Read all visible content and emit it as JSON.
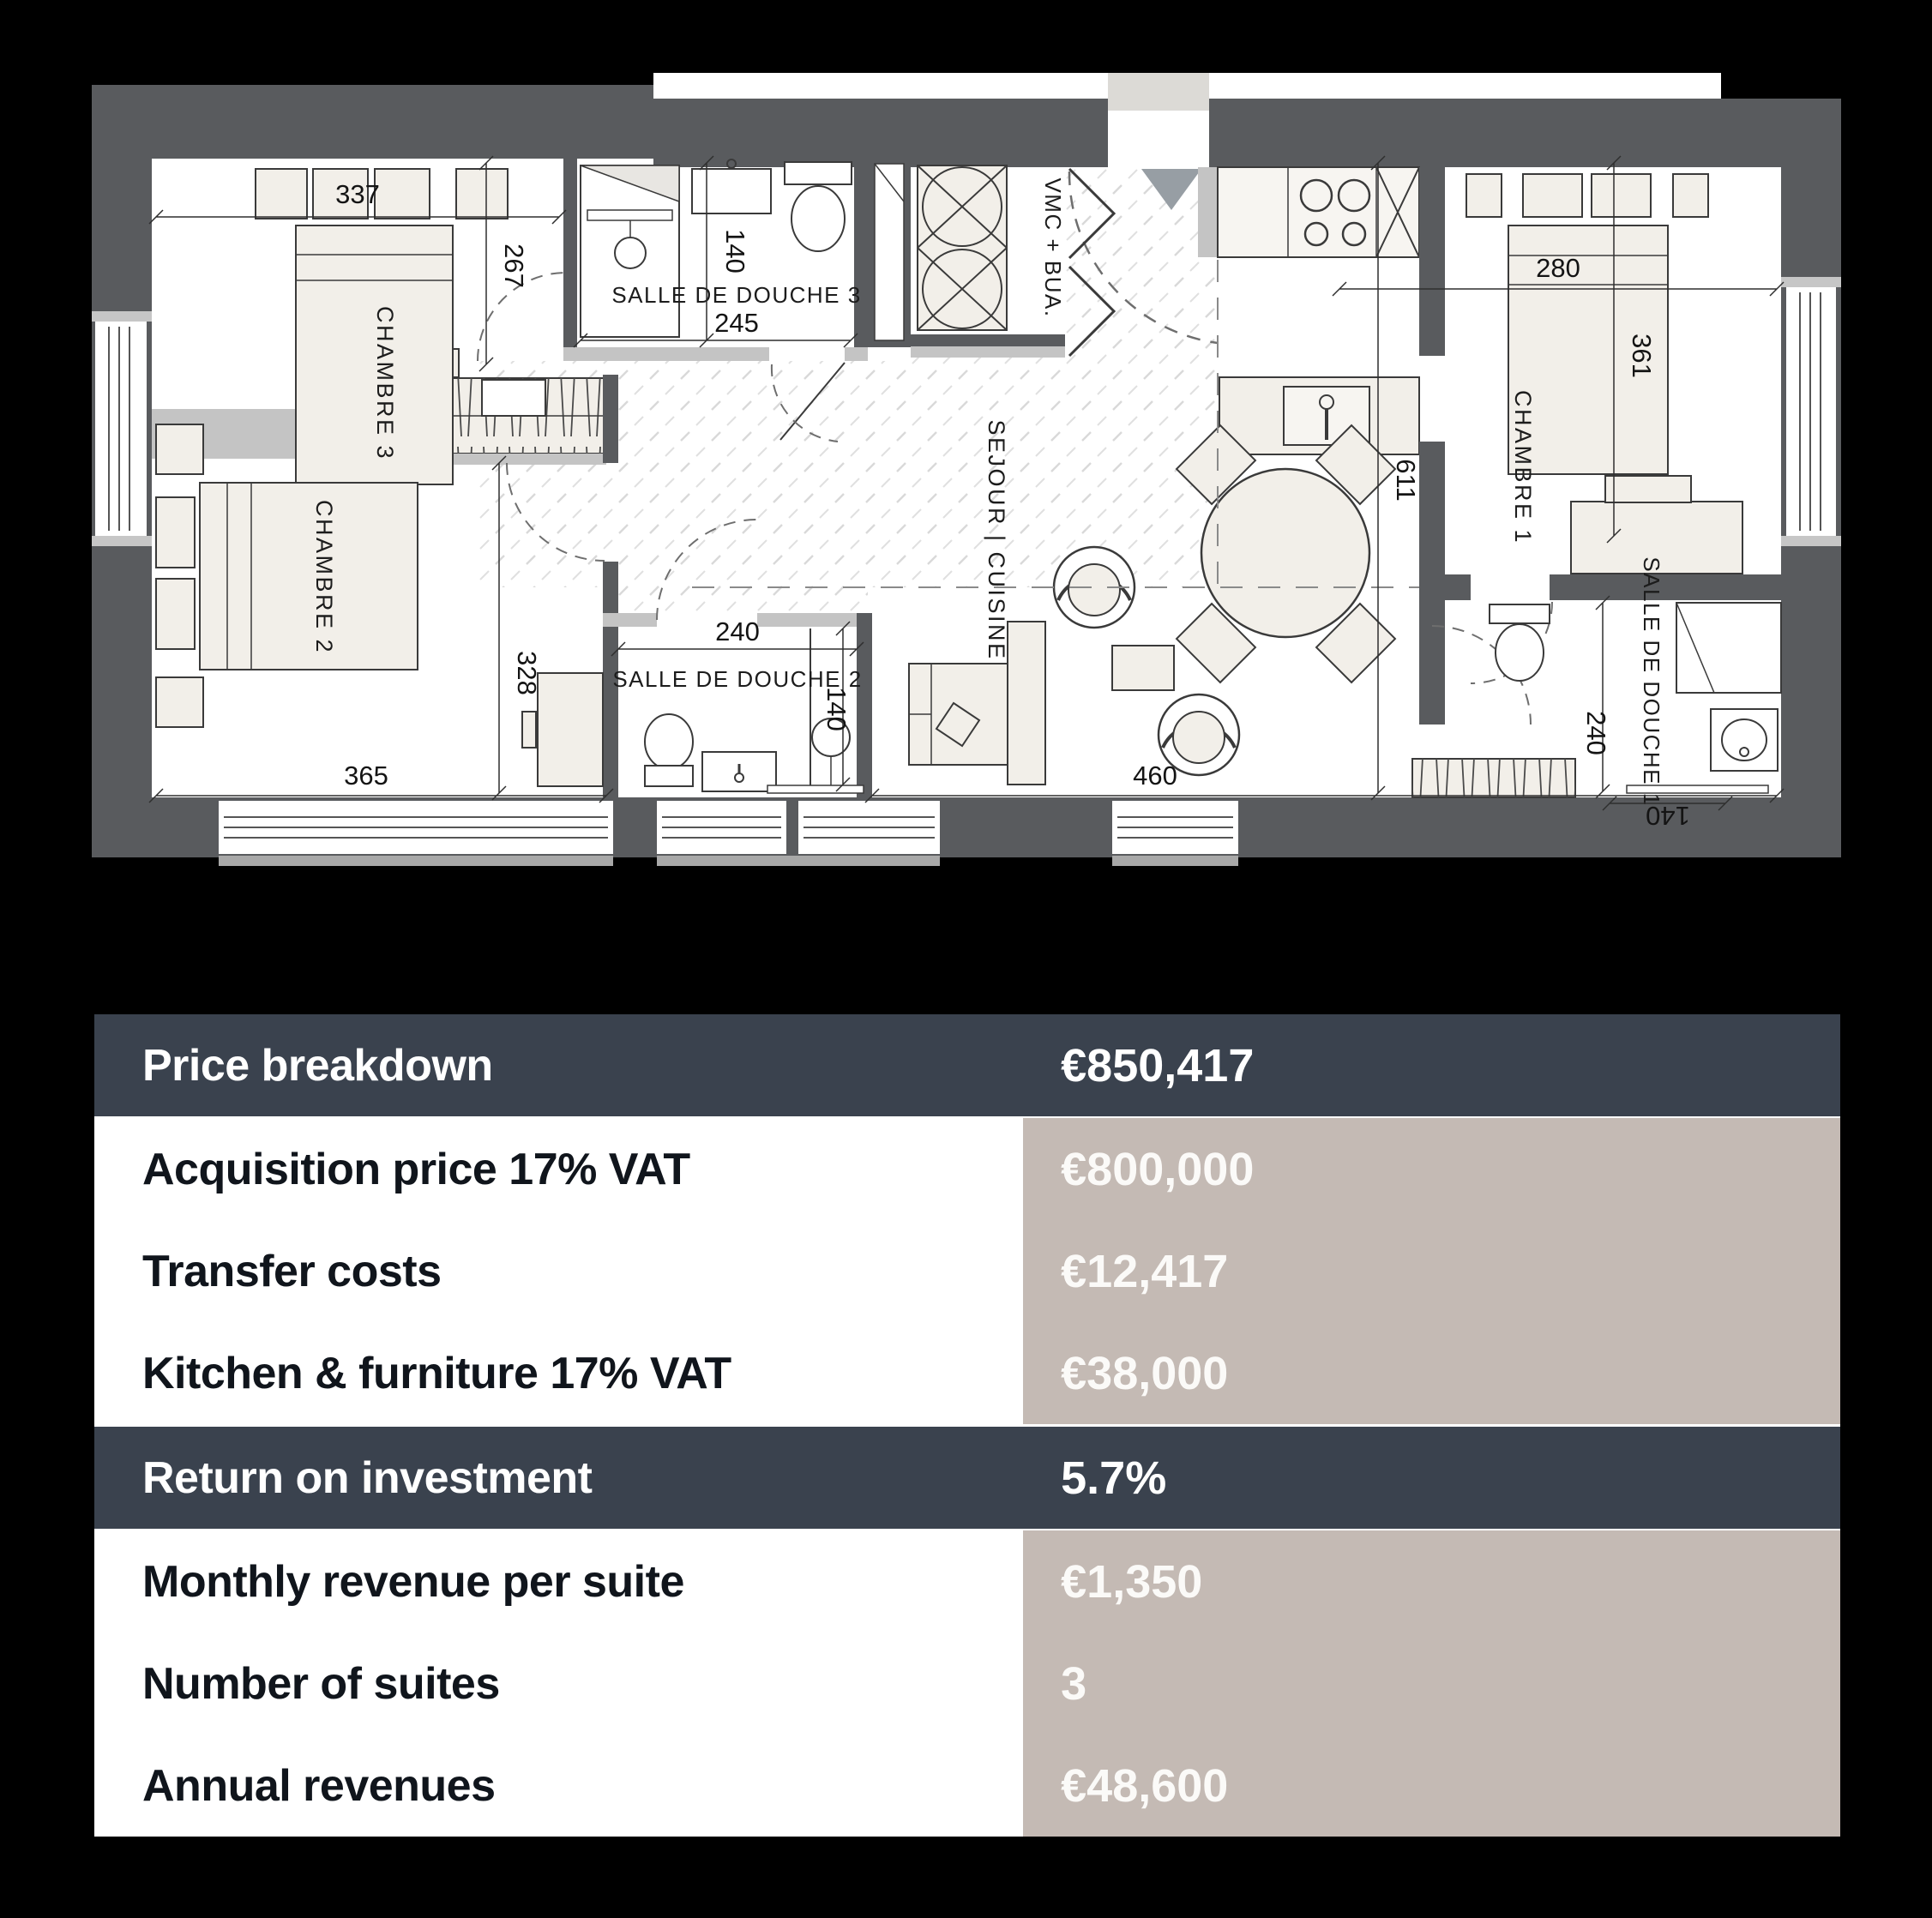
{
  "plan": {
    "rooms": {
      "chambre3": "CHAMBRE 3",
      "chambre2": "CHAMBRE 2",
      "chambre1": "CHAMBRE 1",
      "sdd3": "SALLE DE DOUCHE 3",
      "sdd2": "SALLE DE DOUCHE 2",
      "sdd1": "SALLE DE DOUCHE 1",
      "sejour": "SEJOUR | CUISINE",
      "vmc": "VMC + BUA."
    },
    "dims": {
      "chambre3_width": "337",
      "chambre3_height": "267",
      "sdd3_height": "140",
      "sdd3_width": "245",
      "chambre1_width": "280",
      "chambre1_height": "361",
      "sejour_height": "611",
      "chambre2_height": "328",
      "chambre2_width": "365",
      "sdd2_width": "240",
      "sdd2_height": "140",
      "sejour_width": "460",
      "sdd1_height": "240",
      "sdd1_width": "140"
    }
  },
  "table": {
    "rows": [
      {
        "label": "Price breakdown",
        "value": "€850,417",
        "type": "header"
      },
      {
        "label": "Acquisition price 17% VAT",
        "value": "€800,000",
        "type": "data"
      },
      {
        "label": "Transfer costs",
        "value": "€12,417",
        "type": "data"
      },
      {
        "label": "Kitchen & furniture 17% VAT",
        "value": "€38,000",
        "type": "data"
      },
      {
        "label": "Return on investment",
        "value": "5.7%",
        "type": "header"
      },
      {
        "label": "Monthly revenue per suite",
        "value": "€1,350",
        "type": "data"
      },
      {
        "label": "Number of suites",
        "value": "3",
        "type": "data"
      },
      {
        "label": "Annual revenues",
        "value": "€48,600",
        "type": "data"
      }
    ]
  },
  "colors": {
    "background": "#000000",
    "wall": "#595b5e",
    "wall_light": "#c6c6c6",
    "furniture": "#f2efe9",
    "header_row": "#3a424e",
    "value_cell": "#c4bab4",
    "label_cell": "#ffffff"
  }
}
